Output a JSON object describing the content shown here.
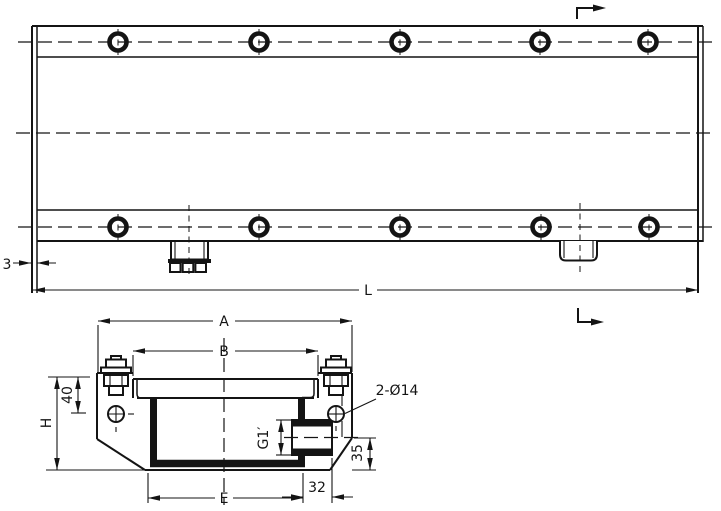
{
  "colors": {
    "ink": "#141414",
    "paper": "#ffffff"
  },
  "views": {
    "plan": {
      "dims": {
        "thickness": "3",
        "length": "L"
      }
    },
    "section": {
      "dims": {
        "overall_width": "A",
        "flange_width": "B",
        "height": "H",
        "hole_offset": "40",
        "port_thread": "G1′",
        "port_height": "35",
        "lip_offset": "32",
        "inner_width": "E"
      },
      "callout_holes": "2-Ø14"
    }
  }
}
